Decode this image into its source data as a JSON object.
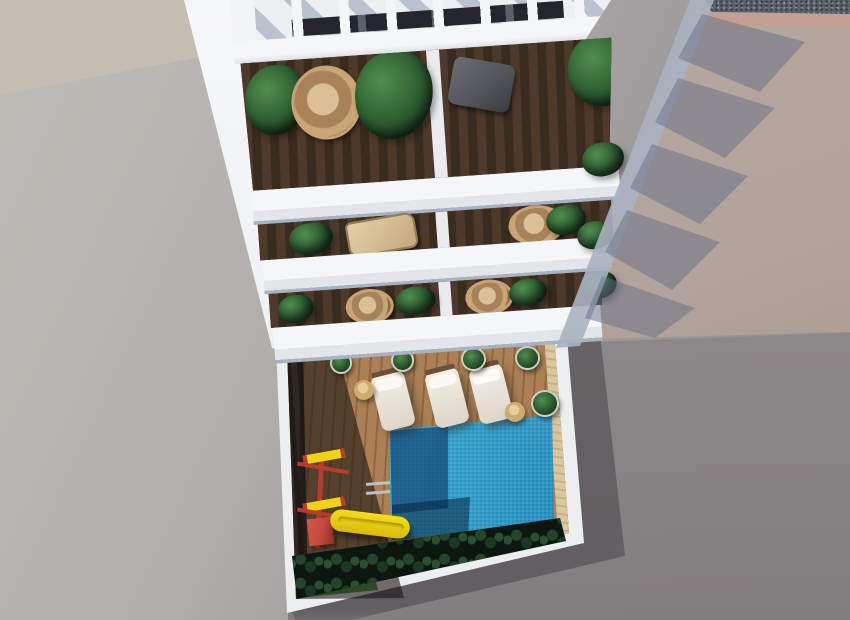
{
  "scene": {
    "type": "3d-architectural-render",
    "view": "top-down aerial view of a white residential building with stacked balconies, a rooftop pergola and a ground-floor courtyard with swimming pool",
    "building": {
      "pergola_slat_count": 10,
      "balcony_rail_bands": 3,
      "balconies_per_floor": 2,
      "balcony_items": [
        "palm-plant",
        "hanging-rattan-chair",
        "banana-plant",
        "gray-recliner",
        "wicker-armchairs",
        "potted-plants"
      ]
    },
    "courtyard": {
      "pool": "rectangular blue mosaic pool with corner steps and ladder",
      "lounger_count": 3,
      "side_table_count": 2,
      "playground": "red and yellow swing frame with yellow slide",
      "hedge": "dark green hedge along south wall",
      "deck": "wooden deck, west half in building shadow"
    },
    "ground": {
      "left": "light gray concrete",
      "top_left": "beige concrete",
      "top_right": "beige terrace with gravel strip and sawtooth balcony shadows",
      "bottom_right": "darker gray surface in shade"
    },
    "palette": {
      "ground_left_light": "#c0bcb8",
      "ground_left_dark": "#a19d9e",
      "ground_topleft": "#c6beb3",
      "right_beige": "#b2a49a",
      "right_gray": "#8f8a8b",
      "gravel": "#59616d",
      "gravel_edge": "#c49f92",
      "wall_white": "#f2f3f5",
      "wall_wedge": "#eef0f3",
      "slab_top": "#f4f5f7",
      "slab_front": "#dfe3e9",
      "slab_shadow": "#a8b2c1",
      "sidewall": "#a9b2c0",
      "cast_shadow": "rgba(104,112,134,0.5)",
      "interior_wood": "#3a2b1f",
      "deck_light": "#ab8056",
      "deck_shadow": "rgba(28,22,19,0.6)",
      "west_wall": "#27211d",
      "east_wall": "#d3c096",
      "border_white": "#eceef0",
      "pool_deep": "#14507f",
      "pool_mid": "#2492c4",
      "pool_bright": "#55c4e4",
      "pool_steps": "rgba(9,44,90,0.55)",
      "pool_corner": "rgba(4,26,52,0.5)",
      "hedge": "#0c1710",
      "grass": "#2b4827",
      "foliage": "#2c5a30",
      "rattan": "#c8a272",
      "divider_white": "#e9ebee",
      "recliner_gray": "#53565c",
      "lounger_white": "#eeeae0",
      "slide_yellow": "#f0d414",
      "play_red": "#b83b2d",
      "play_box": "#c24a3e",
      "ladder_gray": "#b9c2c6"
    }
  }
}
